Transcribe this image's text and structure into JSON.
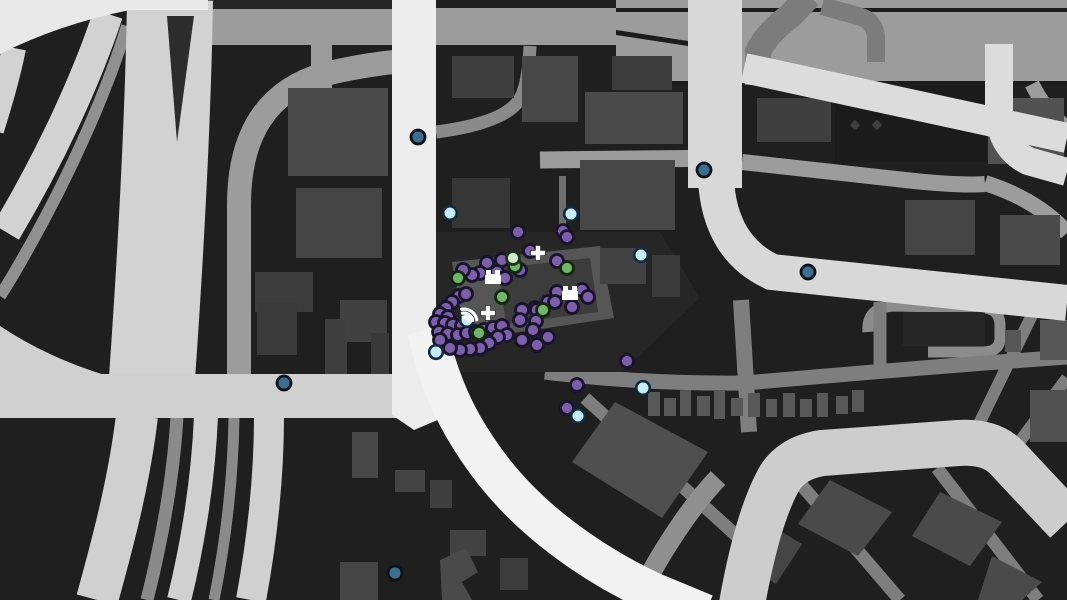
{
  "app": {
    "name": "gta-style-pause-map",
    "description": "In-game street map view with player and crew blips clustered on a city block"
  },
  "map": {
    "background_color": "#1f1f1f",
    "palette": {
      "highway_white": "#f2f2f2",
      "road_white": "#ededed",
      "road_light": "#d0d0d0",
      "road_medium": "#9c9c9c",
      "road_dark_gray": "#7c7c7c",
      "district_gray": "#9c9c9c",
      "block_dark": "#262626",
      "building_gray": "#4a4a4a",
      "slab_gray": "#565656",
      "icon_white": "#ffffff"
    },
    "blip_styles": {
      "purple": {
        "fill": "#7b5fa9",
        "stroke": "#18122b",
        "radius": 6.5,
        "stroke_width": 2.8
      },
      "green": {
        "fill": "#72b469",
        "stroke": "#12260f",
        "radius": 6.5,
        "stroke_width": 2.8
      },
      "pale_green": {
        "fill": "#cfeccc",
        "stroke": "#1c3318",
        "radius": 6.5,
        "stroke_width": 2.8
      },
      "light_blue": {
        "fill": "#c9edf8",
        "stroke": "#0f2b3d",
        "radius": 6.8,
        "stroke_width": 2.6
      },
      "dark_blue": {
        "fill": "#3d6e8e",
        "stroke": "#081018",
        "radius": 7.0,
        "stroke_width": 2.8
      }
    },
    "blips": {
      "purple": [
        [
          563,
          231
        ],
        [
          567,
          237
        ],
        [
          518,
          232
        ],
        [
          530,
          251
        ],
        [
          502,
          260
        ],
        [
          520,
          270
        ],
        [
          557,
          261
        ],
        [
          487,
          263
        ],
        [
          497,
          272
        ],
        [
          505,
          278
        ],
        [
          480,
          273
        ],
        [
          472,
          275
        ],
        [
          463,
          270
        ],
        [
          557,
          292
        ],
        [
          582,
          290
        ],
        [
          588,
          297
        ],
        [
          548,
          302
        ],
        [
          572,
          307
        ],
        [
          535,
          308
        ],
        [
          522,
          310
        ],
        [
          555,
          302
        ],
        [
          537,
          310
        ],
        [
          520,
          320
        ],
        [
          536,
          321
        ],
        [
          459,
          296
        ],
        [
          466,
          294
        ],
        [
          452,
          302
        ],
        [
          446,
          308
        ],
        [
          440,
          314
        ],
        [
          448,
          317
        ],
        [
          436,
          322
        ],
        [
          445,
          323
        ],
        [
          453,
          325
        ],
        [
          462,
          326
        ],
        [
          439,
          332
        ],
        [
          448,
          334
        ],
        [
          458,
          335
        ],
        [
          467,
          333
        ],
        [
          476,
          332
        ],
        [
          484,
          330
        ],
        [
          493,
          328
        ],
        [
          502,
          326
        ],
        [
          507,
          335
        ],
        [
          498,
          337
        ],
        [
          489,
          343
        ],
        [
          480,
          348
        ],
        [
          470,
          349
        ],
        [
          460,
          350
        ],
        [
          450,
          348
        ],
        [
          440,
          340
        ],
        [
          533,
          330
        ],
        [
          522,
          340
        ],
        [
          537,
          345
        ],
        [
          548,
          337
        ],
        [
          627,
          361
        ],
        [
          577,
          385
        ],
        [
          567,
          408
        ]
      ],
      "green": [
        [
          458,
          278
        ],
        [
          515,
          266
        ],
        [
          567,
          268
        ],
        [
          543,
          310
        ],
        [
          479,
          333
        ],
        [
          502,
          297
        ]
      ],
      "pale_green": [
        [
          513,
          258
        ]
      ],
      "light_blue": [
        [
          450,
          213
        ],
        [
          571,
          214
        ],
        [
          641,
          255
        ],
        [
          436,
          352
        ],
        [
          467,
          320
        ],
        [
          643,
          388
        ],
        [
          578,
          416
        ]
      ],
      "dark_blue": [
        [
          418,
          137
        ],
        [
          704,
          170
        ],
        [
          808,
          272
        ],
        [
          284,
          383
        ],
        [
          395,
          573
        ]
      ]
    },
    "icons": [
      {
        "type": "shop-building-icon",
        "x": 493,
        "y": 277
      },
      {
        "type": "shop-building-icon",
        "x": 570,
        "y": 293
      },
      {
        "type": "health-cross-icon",
        "x": 538,
        "y": 253
      },
      {
        "type": "health-cross-icon",
        "x": 488,
        "y": 313
      },
      {
        "type": "signal-arcs-icon",
        "x": 464,
        "y": 322
      }
    ],
    "decor_diamonds": {
      "color": "#3f3f3f",
      "points": [
        [
          855,
          125
        ],
        [
          877,
          125
        ]
      ]
    }
  }
}
